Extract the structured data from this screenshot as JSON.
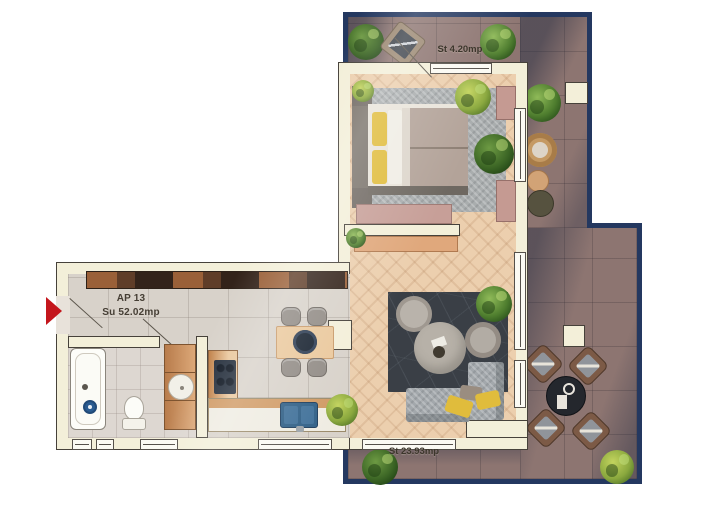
{
  "labels": {
    "apartment_unit": "AP 13",
    "apartment_area": "Su 52.02mp",
    "terrace_top_area": "St 4.20mp",
    "terrace_main_area": "St 23.93mp"
  },
  "colors": {
    "background": "#ffffff",
    "wall_fill": "#f3efd9",
    "wall_outline": "#46413a",
    "terrace_border": "#243860",
    "terrace_paving": "#8d7571",
    "wood_floor": "#eccfae",
    "tile_floor": "#d8d2ca",
    "label_text": "#453e34",
    "entrance_arrow": "#c4161c",
    "accent_yellow": "#e0bc3c",
    "sink_blue": "#2f5f86"
  },
  "icons": {
    "entrance_arrow": "right-pointing red triangle marking the apartment entrance",
    "plant": "green circular potted plant, top view"
  }
}
